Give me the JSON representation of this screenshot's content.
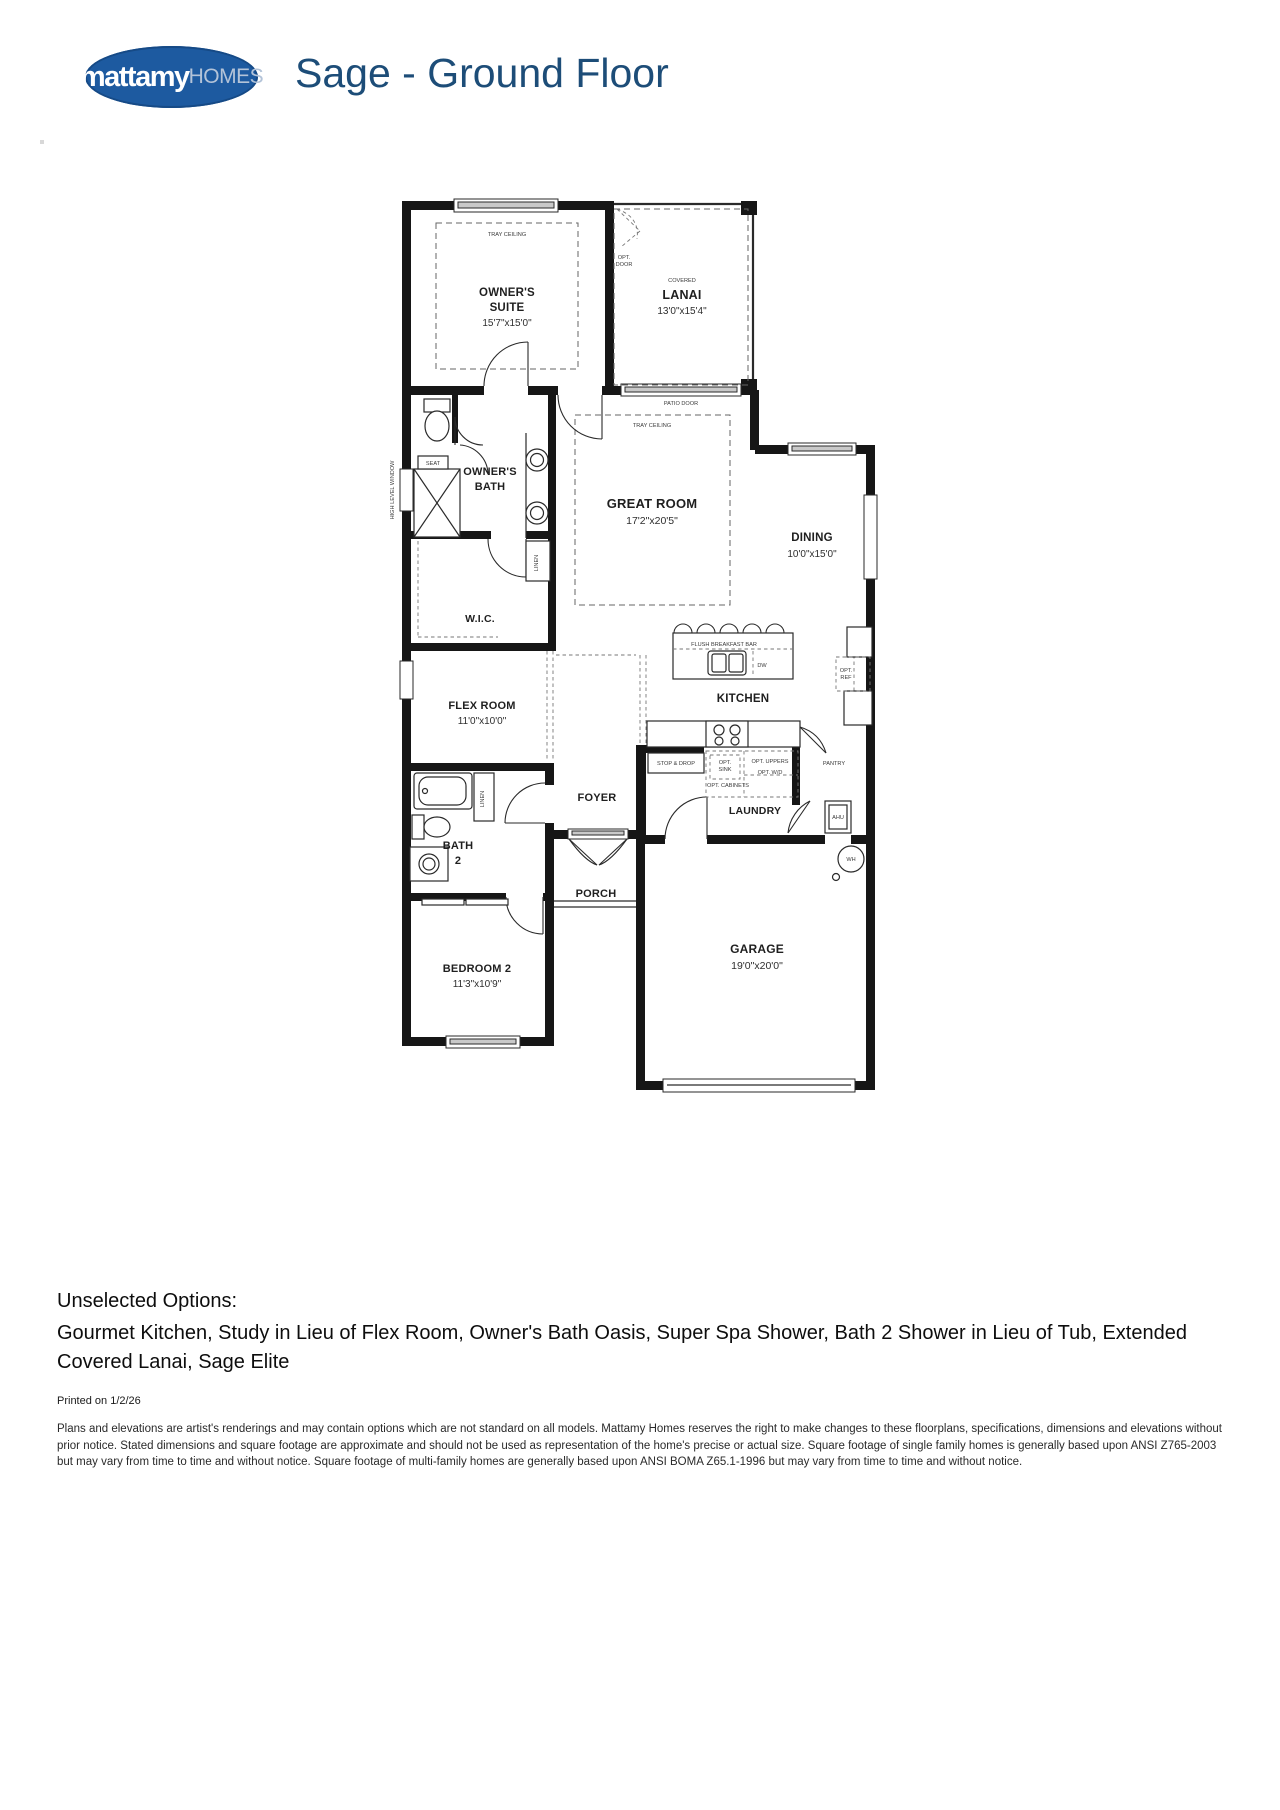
{
  "header": {
    "logo_primary": "mattamy",
    "logo_secondary": "HOMES",
    "title": "Sage - Ground Floor",
    "brand_blue": "#1d5aa0",
    "title_blue": "#1d4d78"
  },
  "plan": {
    "rooms": {
      "owners_suite": {
        "l1": "OWNER'S",
        "l2": "SUITE",
        "dims": "15'7\"x15'0\""
      },
      "lanai": {
        "tag": "COVERED",
        "name": "LANAI",
        "dims": "13'0\"x15'4\""
      },
      "great_room": {
        "name": "GREAT ROOM",
        "dims": "17'2\"x20'5\""
      },
      "dining": {
        "name": "DINING",
        "dims": "10'0\"x15'0\""
      },
      "owners_bath": {
        "l1": "OWNER'S",
        "l2": "BATH"
      },
      "wic": {
        "name": "W.I.C."
      },
      "flex_room": {
        "name": "FLEX ROOM",
        "dims": "11'0\"x10'0\""
      },
      "kitchen": {
        "name": "KITCHEN"
      },
      "laundry": {
        "name": "LAUNDRY"
      },
      "pantry": {
        "name": "PANTRY"
      },
      "foyer": {
        "name": "FOYER"
      },
      "bath2": {
        "l1": "BATH",
        "l2": "2"
      },
      "porch": {
        "name": "PORCH"
      },
      "bedroom2": {
        "name": "BEDROOM 2",
        "dims": "11'3\"x10'9\""
      },
      "garage": {
        "name": "GARAGE",
        "dims": "19'0\"x20'0\""
      }
    },
    "labels": {
      "tray_ceiling": "TRAY CEILING",
      "opt": "OPT.",
      "door": "DOOR",
      "patio_door": "PATIO DOOR",
      "high_level_window": "HIGH LEVEL WINDOW",
      "seat": "SEAT",
      "linen": "LINEN",
      "flush_breakfast_bar": "FLUSH BREAKFAST BAR",
      "dw": "DW",
      "ref": "REF",
      "stop_drop": "STOP & DROP",
      "sink": "SINK",
      "opt_uppers": "OPT. UPPERS",
      "opt_wd": "OPT. W/D",
      "opt_cabinets": "OPT. CABINETS",
      "ahu": "AHU",
      "wh": "WH"
    }
  },
  "footer": {
    "unselected_title": "Unselected Options:",
    "unselected_list": "Gourmet Kitchen, Study in Lieu of Flex Room, Owner's Bath Oasis, Super Spa Shower, Bath 2 Shower in Lieu of Tub, Extended Covered Lanai, Sage Elite",
    "printed": "Printed on 1/2/26",
    "disclaimer": "Plans and elevations are artist's renderings and may contain options which are not standard on all models. Mattamy Homes reserves the right to make changes to these floorplans, specifications, dimensions and elevations without prior notice. Stated dimensions and square footage are approximate and should not be used as representation of the home's precise or actual size. Square footage of single family homes is generally based upon ANSI Z765-2003 but may vary from time to time and without notice. Square footage of multi-family homes are generally based upon ANSI BOMA Z65.1-1996 but may vary from time to time and without notice."
  }
}
